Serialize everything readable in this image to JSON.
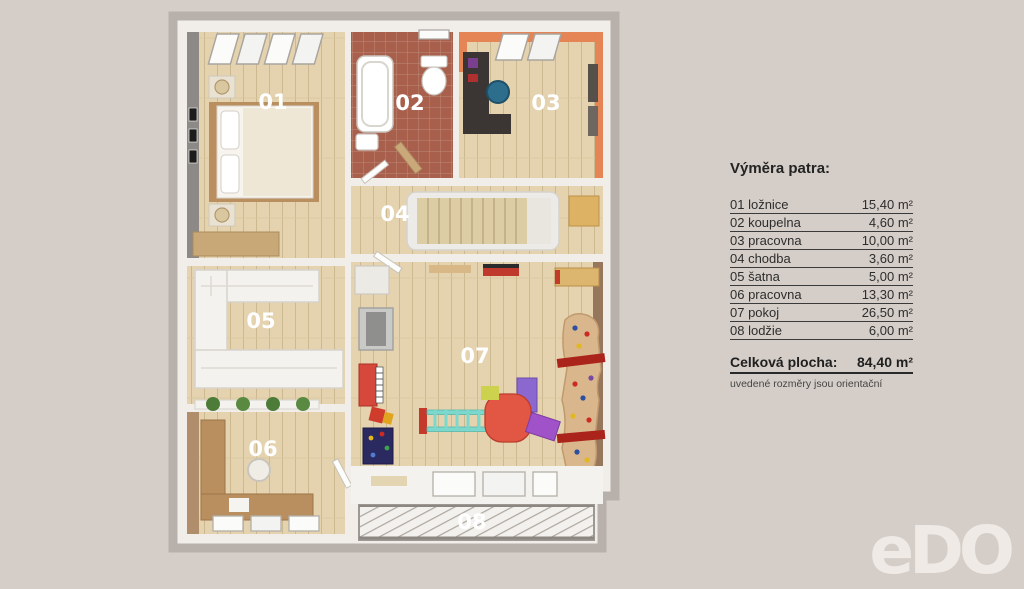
{
  "legend": {
    "title": "Výměra patra:",
    "rows": [
      {
        "label": "01 ložnice",
        "value": "15,40 m²"
      },
      {
        "label": "02 koupelna",
        "value": "4,60 m²"
      },
      {
        "label": "03 pracovna",
        "value": "10,00 m²"
      },
      {
        "label": "04 chodba",
        "value": "3,60 m²"
      },
      {
        "label": "05 šatna",
        "value": "5,00 m²"
      },
      {
        "label": "06 pracovna",
        "value": "13,30 m²"
      },
      {
        "label": "07 pokoj",
        "value": "26,50 m²"
      },
      {
        "label": "08 lodžie",
        "value": "6,00 m²"
      }
    ],
    "total_label": "Celková plocha:",
    "total_value": "84,40 m²",
    "note": "uvedené rozměry jsou orientační"
  },
  "floorplan": {
    "rooms": [
      {
        "number": "01"
      },
      {
        "number": "02"
      },
      {
        "number": "03"
      },
      {
        "number": "04"
      },
      {
        "number": "05"
      },
      {
        "number": "06"
      },
      {
        "number": "07"
      },
      {
        "number": "08"
      }
    ]
  },
  "logo": {
    "text": "eDO"
  },
  "colors": {
    "background": "#d5cec8",
    "outer_wall": "#b7b0ab",
    "inner_wall": "#f1eeea",
    "wood_floor": "#e4d3ae",
    "bathroom_tile": "#a85f4c",
    "accent_orange": "#e58455",
    "brown_wall": "#97775b",
    "legend_text": "#2d2d2d",
    "room_number_text": "#ffffff",
    "logo_color": "#efeae5"
  }
}
